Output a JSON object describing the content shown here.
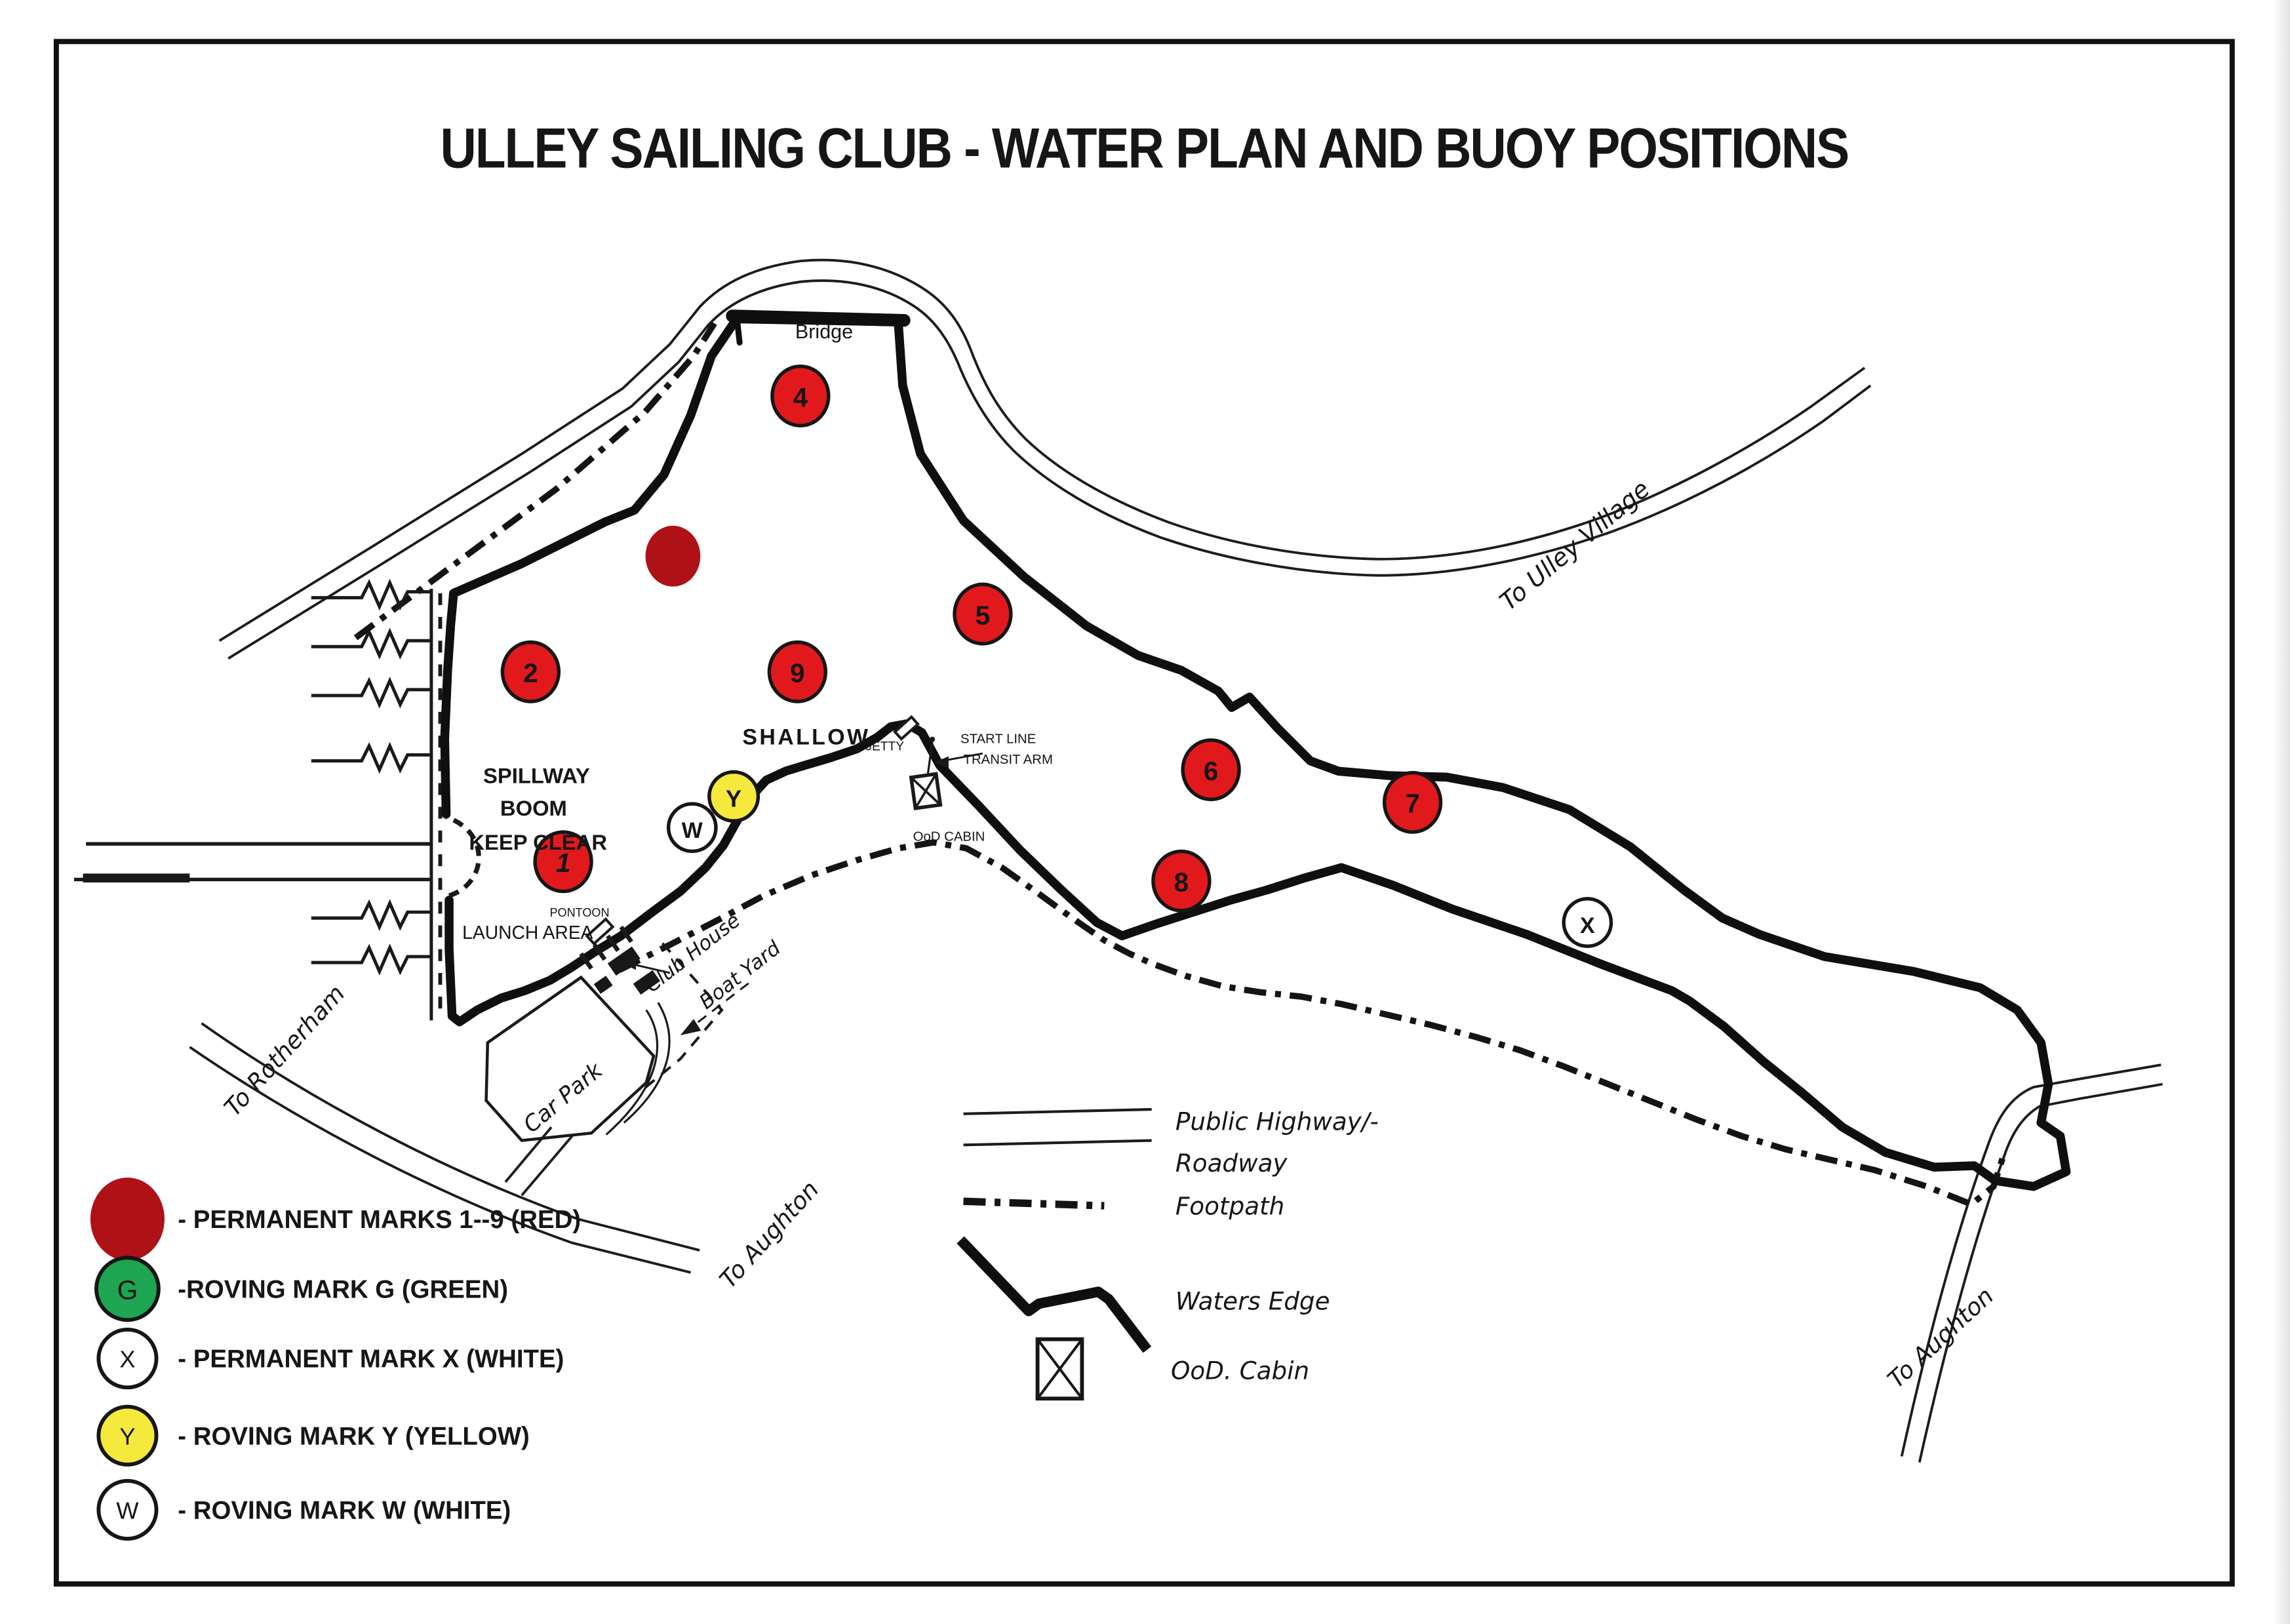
{
  "title": "ULLEY SAILING CLUB - WATER PLAN AND BUOY POSITIONS",
  "colors": {
    "permanent_red": "#e2191c",
    "dark_red": "#ae1116",
    "green": "#1da551",
    "yellow": "#f4e93c",
    "white": "#ffffff",
    "keep_clear_red": "#c9372f",
    "ink": "#181818"
  },
  "map": {
    "labels": {
      "bridge": "Bridge",
      "to_ulley_village": "To Ulley Village",
      "shallow": "SHALLOW",
      "jetty": "JETTY",
      "start_line": "START LINE",
      "transit_arm": "TRANSIT ARM",
      "ood_cabin": "OoD CABIN",
      "spillway_1": "SPILLWAY",
      "spillway_2": "BOOM",
      "keep_clear": "KEEP CLEAR",
      "pontoon": "PONTOON",
      "launch_area": "LAUNCH AREA",
      "club_house": "Club House",
      "boat_yard": "Boat Yard",
      "car_park": "Car Park",
      "to_rotherham": "To Rotherham",
      "to_aughton_west": "To Aughton",
      "to_aughton_east": "To Aughton"
    },
    "permanent_marks": [
      {
        "label": "1"
      },
      {
        "label": "2"
      },
      {
        "label": "4"
      },
      {
        "label": "5"
      },
      {
        "label": "6"
      },
      {
        "label": "7"
      },
      {
        "label": "8"
      },
      {
        "label": "9"
      }
    ],
    "roving_marks": [
      {
        "label": "Y"
      },
      {
        "label": "W"
      },
      {
        "label": "X"
      }
    ]
  },
  "legend": {
    "marks": [
      {
        "symbol": "",
        "label": "- PERMANENT MARKS 1--9 (RED)"
      },
      {
        "symbol": "G",
        "label": "-ROVING MARK G (GREEN)"
      },
      {
        "symbol": "X",
        "label": "- PERMANENT MARK X (WHITE)"
      },
      {
        "symbol": "Y",
        "label": "- ROVING MARK Y (YELLOW)"
      },
      {
        "symbol": "W",
        "label": "- ROVING MARK W (WHITE)"
      }
    ],
    "lines": [
      {
        "key": "roadway",
        "label_1": "Public Highway/-",
        "label_2": "Roadway"
      },
      {
        "key": "footpath",
        "label": "Footpath"
      },
      {
        "key": "waters_edge",
        "label": "Waters Edge"
      },
      {
        "key": "ood_cabin",
        "label": "OoD. Cabin"
      }
    ]
  }
}
